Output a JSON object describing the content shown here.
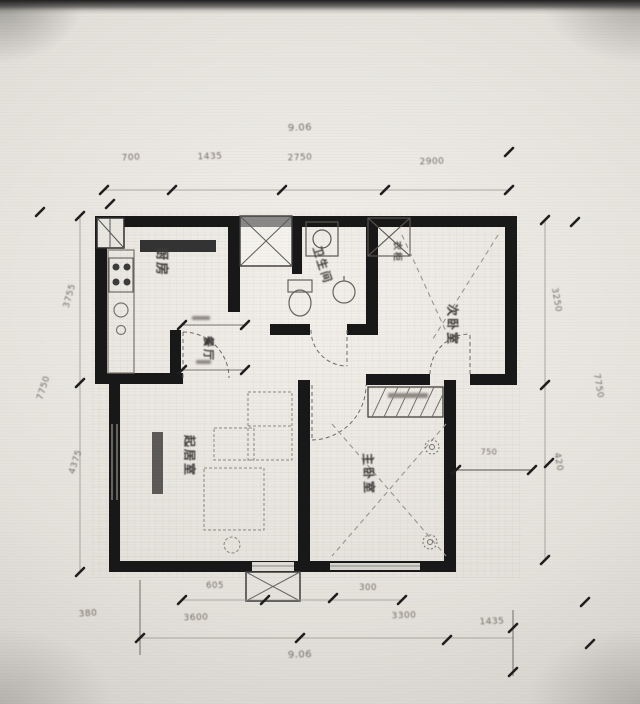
{
  "floorplan": {
    "rooms": {
      "kitchen": "厨房",
      "dining": "餐厅",
      "bathroom": "卫生间",
      "bedroom2": "次卧室",
      "living": "起居室",
      "master": "主卧室",
      "wardrobe": "衣柜"
    },
    "dimensions": {
      "top": {
        "total": "9.06",
        "seg1": "700",
        "seg2": "1435",
        "seg3": "2750",
        "seg4": "2900"
      },
      "bottom": {
        "total": "9.06",
        "seg1": "380",
        "seg2": "3600",
        "seg3": "3300",
        "seg4": "1435",
        "inner1": "605",
        "inner2": "300"
      },
      "left": {
        "seg1": "3755",
        "total": "7750",
        "seg2": "4375"
      },
      "right": {
        "seg1": "3250",
        "seg2": "420",
        "total": "7750",
        "inner": "750"
      }
    },
    "colors": {
      "wall": "#181818",
      "paper": "#e4e1db",
      "dim_text": "#767068"
    }
  }
}
